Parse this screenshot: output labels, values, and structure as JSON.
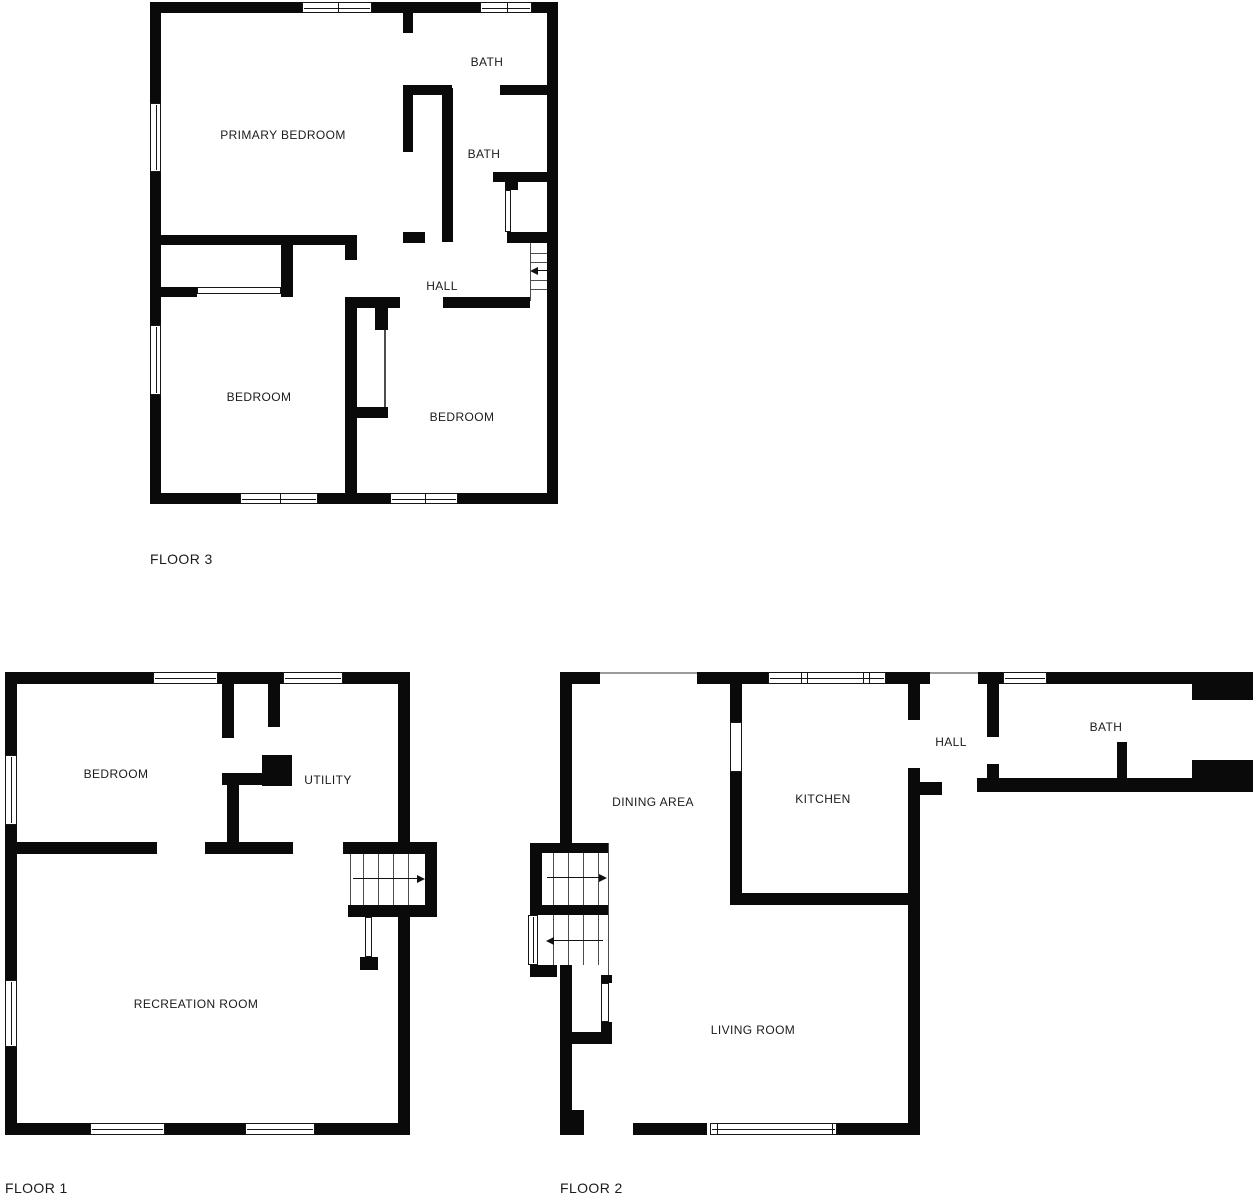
{
  "title": "House floor plan — 3 floors",
  "colors": {
    "wall": "#0a0a0a",
    "background": "#ffffff",
    "text": "#1b1b1b"
  },
  "floors": [
    {
      "id": "floor3",
      "label": "FLOOR 3",
      "rooms": [
        {
          "name": "PRIMARY BEDROOM"
        },
        {
          "name": "BATH"
        },
        {
          "name": "BATH"
        },
        {
          "name": "HALL"
        },
        {
          "name": "BEDROOM"
        },
        {
          "name": "BEDROOM"
        }
      ]
    },
    {
      "id": "floor1",
      "label": "FLOOR 1",
      "rooms": [
        {
          "name": "BEDROOM"
        },
        {
          "name": "UTILITY"
        },
        {
          "name": "RECREATION ROOM"
        }
      ]
    },
    {
      "id": "floor2",
      "label": "FLOOR 2",
      "rooms": [
        {
          "name": "DINING AREA"
        },
        {
          "name": "KITCHEN"
        },
        {
          "name": "HALL"
        },
        {
          "name": "BATH"
        },
        {
          "name": "LIVING ROOM"
        }
      ]
    }
  ]
}
